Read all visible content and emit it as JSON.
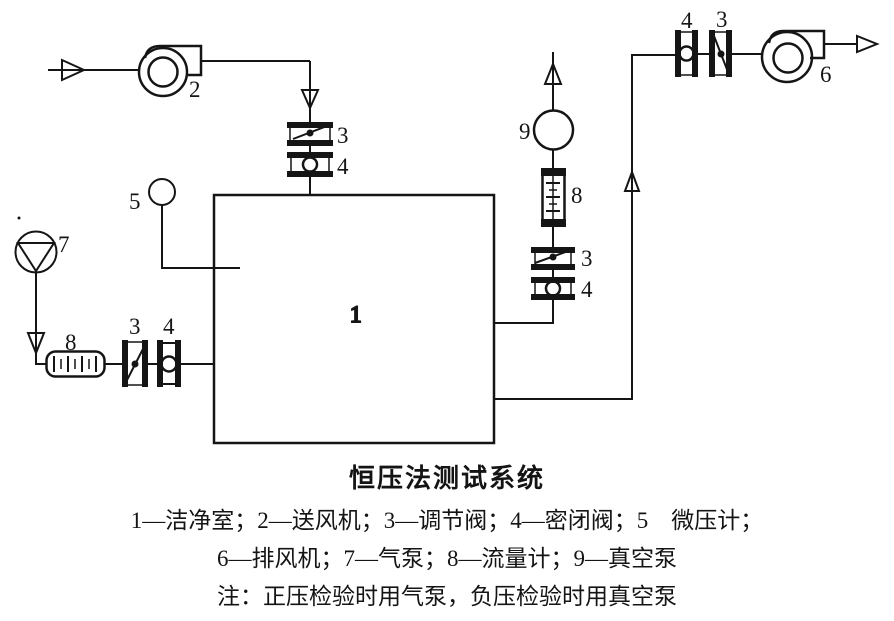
{
  "diagram": {
    "labels": {
      "chamber": "1",
      "supply_fan": "2",
      "top_valve_regulating": "3",
      "top_valve_sealing": "4",
      "micro_manometer": "5",
      "air_pump": "7",
      "left_flowmeter": "8",
      "left_valve_regulating": "3",
      "left_valve_sealing": "4",
      "right_valve_regulating": "3",
      "right_valve_sealing": "4",
      "right_flowmeter": "8",
      "vacuum_pump": "9",
      "outlet_valve_sealing": "4",
      "outlet_valve_regulating": "3",
      "exhaust_fan": "6"
    }
  },
  "caption": {
    "title": "恒压法测试系统",
    "legend_line1": "1—洁净室；2—送风机；3—调节阀；4—密闭阀；5　微压计；",
    "legend_line2": "6—排风机；7—气泵；8—流量计；9—真空泵",
    "note": "注：正压检验时用气泵，负压检验时用真空泵"
  }
}
